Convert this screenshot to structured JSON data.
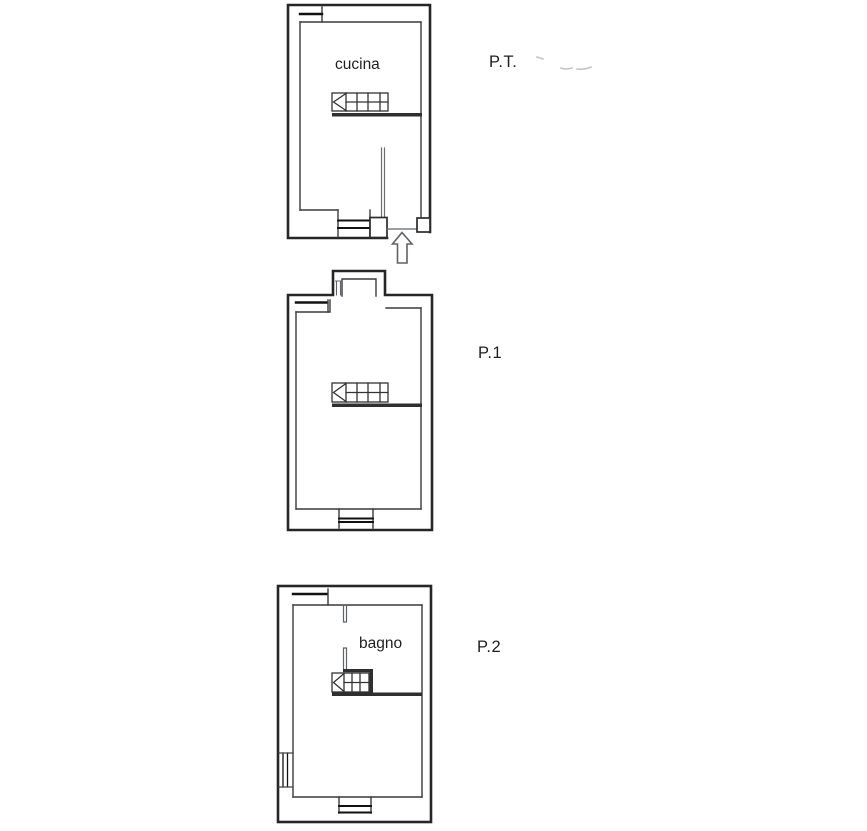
{
  "document": {
    "kind": "floor-plan-drawing",
    "floors": [
      {
        "plan_label": "P.T.",
        "room_label": "cucina"
      },
      {
        "plan_label": "P.1",
        "room_label": ""
      },
      {
        "plan_label": "P.2",
        "room_label": "bagno"
      }
    ]
  },
  "colors": {
    "background": "#ffffff",
    "outer_wall": "#262626",
    "inner_wall": "#3a3a3a",
    "window_line": "#111111",
    "gray_detail": "#5f6368",
    "faded_mark": "#c4c4c4",
    "label_text": "#1f1f1f"
  }
}
